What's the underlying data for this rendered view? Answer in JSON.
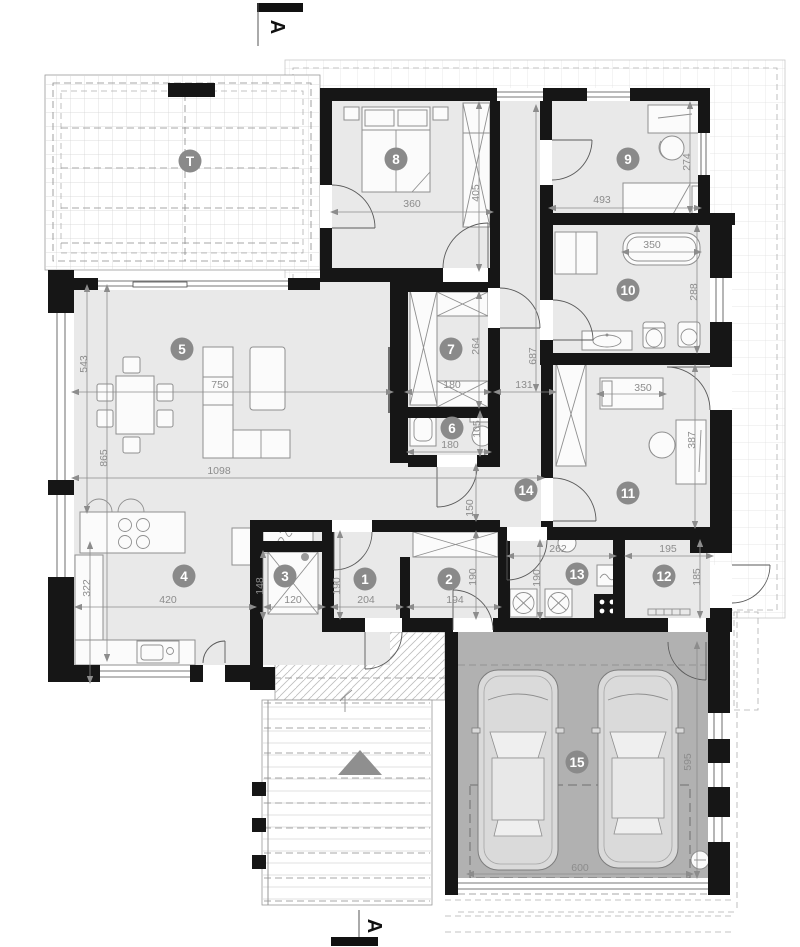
{
  "markers": {
    "section_a_top": "A",
    "section_a_bottom": "A",
    "terrace": "T"
  },
  "rooms": {
    "r1": "1",
    "r2": "2",
    "r3": "3",
    "r4": "4",
    "r5": "5",
    "r6": "6",
    "r7": "7",
    "r8": "8",
    "r9": "9",
    "r10": "10",
    "r11": "11",
    "r12": "12",
    "r13": "13",
    "r14": "14",
    "r15": "15"
  },
  "dims": {
    "d543": "543",
    "d865": "865",
    "d322": "322",
    "d750": "750",
    "d1098": "1098",
    "d420": "420",
    "d148": "148",
    "d120": "120",
    "d190a": "190",
    "d204": "204",
    "d194": "194",
    "d190b": "190",
    "d190c": "190",
    "d262": "262",
    "d195": "195",
    "d185": "185",
    "d360": "360",
    "d405": "405",
    "d493": "493",
    "d274": "274",
    "d350a": "350",
    "d288": "288",
    "d264": "264",
    "d180a": "180",
    "d131": "131",
    "d687": "687",
    "d105": "105",
    "d180b": "180",
    "d150": "150",
    "d350b": "350",
    "d387": "387",
    "d600": "600",
    "d595": "595"
  },
  "colors": {
    "wall": "#161616",
    "floor": "#e9e9e9",
    "garage_floor": "#b1b1b1",
    "badge": "#8a8a8a",
    "dim": "#8c8c8c",
    "triangle": "#8f8f8f"
  }
}
